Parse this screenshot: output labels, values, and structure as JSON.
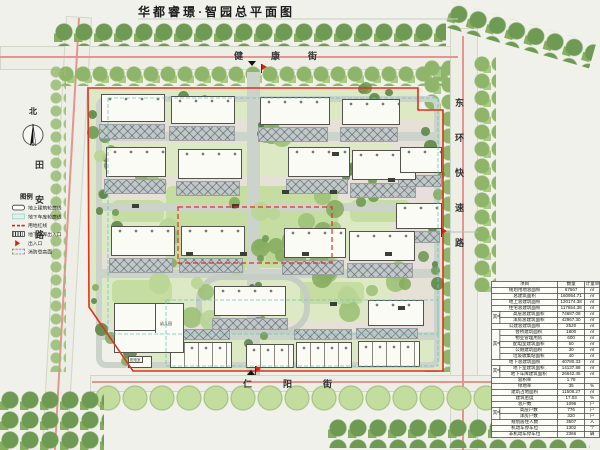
{
  "title": "华都睿璟·智园总平面图",
  "compass": {
    "label": "北"
  },
  "streets": {
    "north": "健康街",
    "south": "仁阳街",
    "west": "田安路",
    "east": "东环快速路"
  },
  "legend": {
    "title": "图例",
    "items": [
      {
        "label": "地上建筑轮廓线",
        "type": "building-outline"
      },
      {
        "label": "地下车库轮廓线",
        "type": "garage-outline"
      },
      {
        "label": "用地红线",
        "type": "red-line"
      },
      {
        "label": "地下车库出入口",
        "type": "garage-entrance"
      },
      {
        "label": "出入口",
        "type": "entrance-flag"
      },
      {
        "label": "消防登高面",
        "type": "fire-surface"
      }
    ]
  },
  "site_labels": {
    "kindergarten": "幼儿园",
    "power_room": "配电室"
  },
  "table": {
    "headers": [
      "项目",
      "数量",
      "计量单位"
    ],
    "rows": [
      {
        "item": "规划用地总面积",
        "qty": "67567",
        "unit": "㎡"
      },
      {
        "item": "总建筑面积",
        "qty": "160954.71",
        "unit": "㎡"
      },
      {
        "item": "地上总建筑面积",
        "qty": "120174.38",
        "unit": "㎡"
      },
      {
        "item": "住宅总建筑面积",
        "qty": "117654.38",
        "unit": "㎡"
      },
      {
        "g": "其中",
        "s": 2,
        "item": "高层总建筑面积",
        "qty": "74687.08",
        "unit": "㎡"
      },
      {
        "sub": true,
        "item": "洋房总建筑面积",
        "qty": "42967.30",
        "unit": "㎡"
      },
      {
        "item": "公建总建筑面积",
        "qty": "2520",
        "unit": "㎡"
      },
      {
        "g": "其中",
        "s": 5,
        "item": "会所建筑面积",
        "qty": "1800",
        "unit": "㎡"
      },
      {
        "sub": true,
        "item": "物业管理用房",
        "qty": "600",
        "unit": "㎡"
      },
      {
        "sub": true,
        "item": "配电室建筑面积",
        "qty": "50",
        "unit": "㎡"
      },
      {
        "sub": true,
        "item": "公厕建筑面积",
        "qty": "30",
        "unit": "㎡"
      },
      {
        "sub": true,
        "item": "垃圾收集站面积",
        "qty": "40",
        "unit": "㎡"
      },
      {
        "item": "地下总建筑面积",
        "qty": "40780.33",
        "unit": "㎡"
      },
      {
        "g": "其中",
        "s": 2,
        "item": "地下室建筑面积",
        "qty": "14137.88",
        "unit": "㎡"
      },
      {
        "sub": true,
        "item": "地下车库建筑面积",
        "qty": "26642.45",
        "unit": "㎡"
      },
      {
        "item": "容积率",
        "qty": "1.78",
        "unit": ""
      },
      {
        "item": "绿地率",
        "qty": "35",
        "unit": "%"
      },
      {
        "item": "建筑占地面积",
        "qty": "11508.27",
        "unit": "㎡"
      },
      {
        "item": "建筑密度",
        "qty": "17.03",
        "unit": "%"
      },
      {
        "item": "总户数",
        "qty": "1096",
        "unit": "户"
      },
      {
        "g": "其中",
        "s": 2,
        "item": "高层户数",
        "qty": "776",
        "unit": "户"
      },
      {
        "sub": true,
        "item": "洋房户数",
        "qty": "320",
        "unit": "户"
      },
      {
        "item": "规划居住人数",
        "qty": "3507",
        "unit": "人"
      },
      {
        "item": "机动车停车位",
        "qty": "1302",
        "unit": "个"
      },
      {
        "item": "非机动车停车位",
        "qty": "2366",
        "unit": "辆"
      }
    ]
  }
}
